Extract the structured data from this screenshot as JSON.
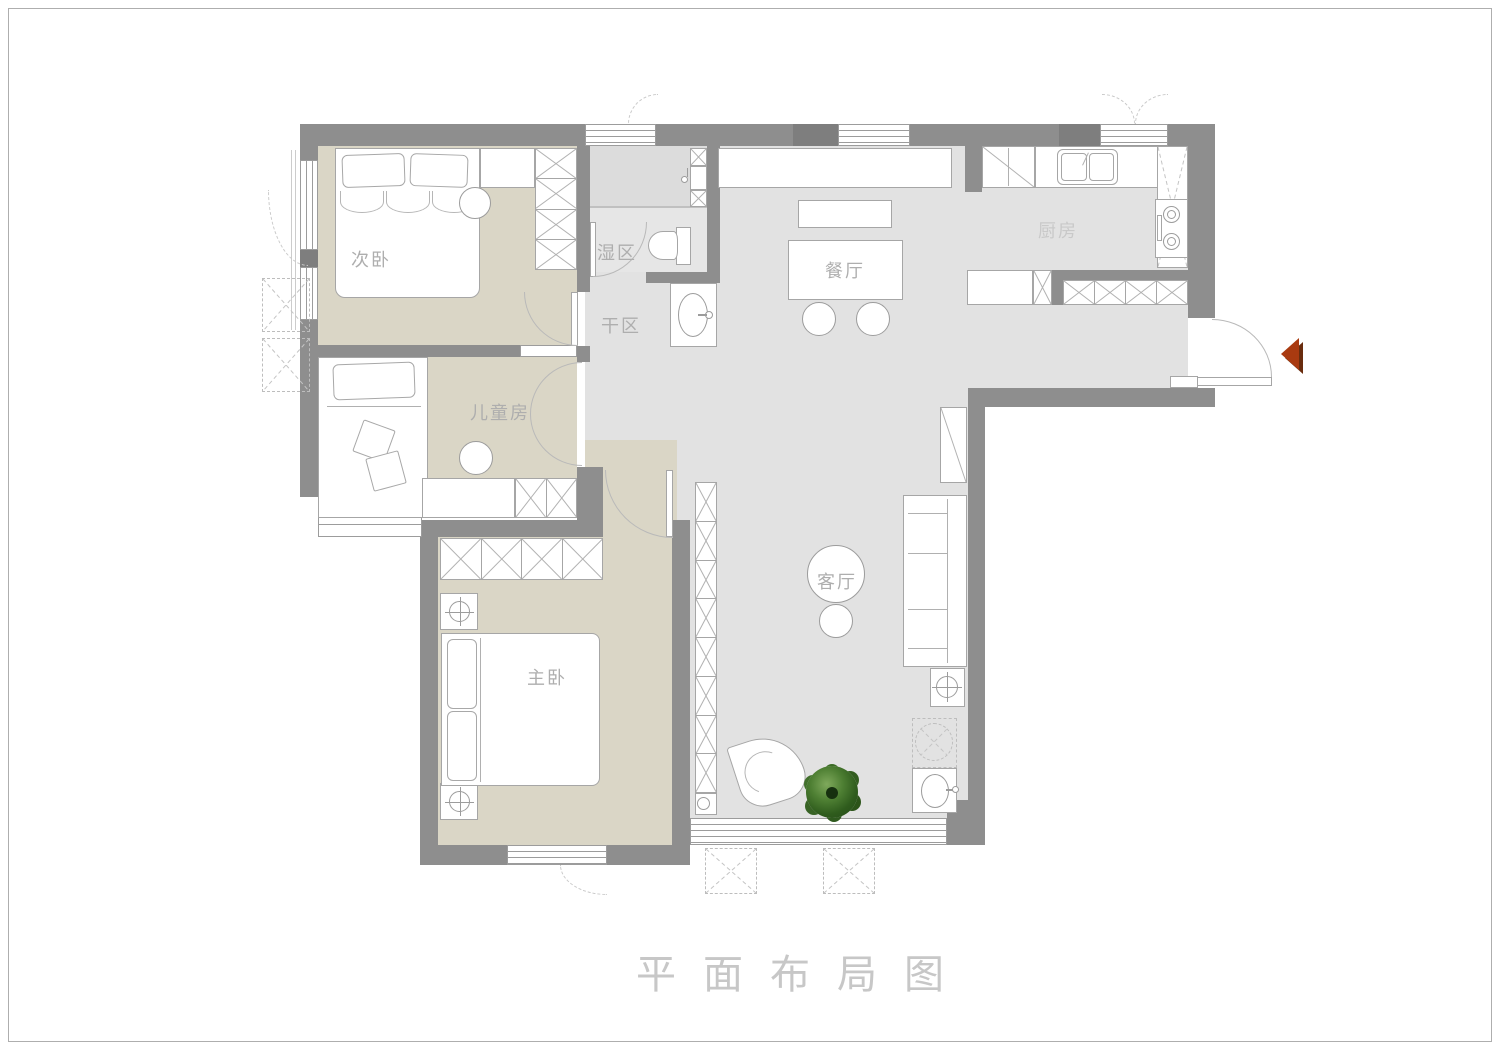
{
  "title": "平面布局图",
  "rooms": {
    "bedroom2": {
      "label": "次卧"
    },
    "kids": {
      "label": "儿童房"
    },
    "master": {
      "label": "主卧"
    },
    "wet": {
      "label": "湿区"
    },
    "dry": {
      "label": "干区"
    },
    "dining": {
      "label": "餐厅"
    },
    "kitchen": {
      "label": "厨房"
    },
    "living": {
      "label": "客厅"
    }
  },
  "colors": {
    "wall": "#8e8e8e",
    "bedroom_floor": "#dad6c6",
    "main_floor": "#e2e2e2",
    "shower_floor": "#dcdcdc",
    "entry_arrow": "#a93a10"
  }
}
